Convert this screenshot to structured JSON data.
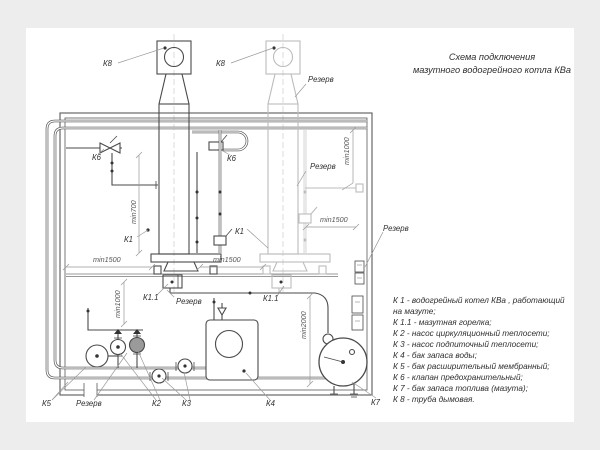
{
  "title": {
    "line1": "Схема подключения",
    "line2": "мазутного водогрейного котла КВа"
  },
  "legend": {
    "lines": [
      "К 1 -  водогрейный котел КВа , работающий",
      "на мазуте;",
      "К 1.1 -  мазутная горелка;",
      "К 2 -  насос циркуляционный теплосети;",
      "К 3 -  насос подпиточный теплосети;",
      "К 4 -  бак запаса воды;",
      "К 5 -  бак расширительный мембранный;",
      "К 6 -  клапан предохранительный;",
      "К 7 -  бак запаса топлива  (мазута);",
      "К 8 -  труба дымовая."
    ]
  },
  "diagram": {
    "labels": {
      "k1": "К1",
      "k1_1": "К1.1",
      "k2": "К2",
      "k3": "К3",
      "k4": "К4",
      "k5": "К5",
      "k6": "К6",
      "k7": "К7",
      "k8": "К8",
      "reserve": "Резерв",
      "min700": "min700",
      "min1000": "min1000",
      "min1500": "min1500",
      "min2000": "min2000"
    }
  },
  "colors": {
    "main_line": "#4a4a4a",
    "reserve_line": "#bcbcbc",
    "dimension_line": "#999999",
    "text": "#2f2f2f",
    "page": "#ffffff",
    "canvas": "#ededed"
  }
}
